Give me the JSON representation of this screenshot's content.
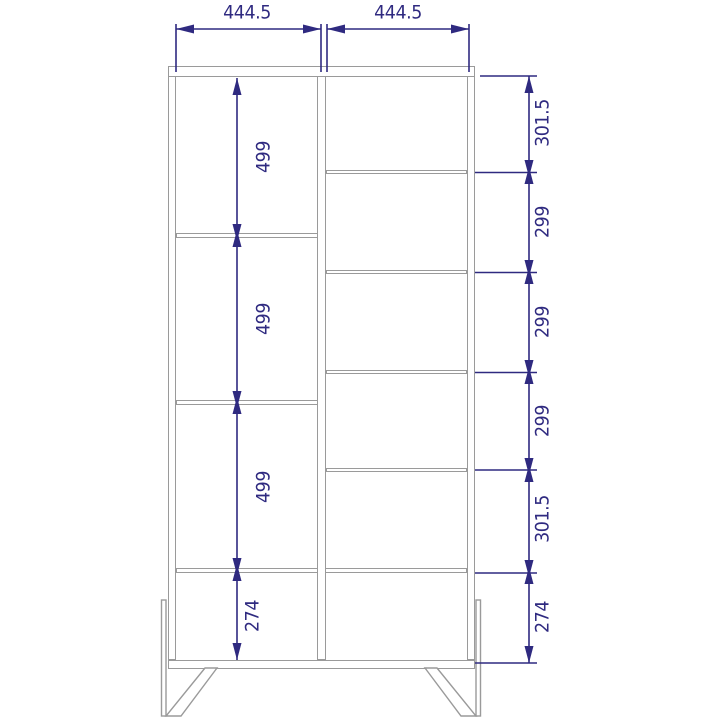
{
  "drawing": {
    "kind": "furniture-technical-drawing",
    "description": "Front elevation of a two-bay shelving cabinet on angled legs, with linear dimension annotations",
    "units": "mm",
    "colors": {
      "dimension_blue": "#2f2a80",
      "outline_gray": "#9a9a9a",
      "background": "#ffffff"
    },
    "top_dimensions": [
      "444.5",
      "444.5"
    ],
    "left_bay_heights": [
      "499",
      "499",
      "499",
      "274"
    ],
    "right_bay_heights": [
      "301.5",
      "299",
      "299",
      "299",
      "301.5",
      "274"
    ]
  }
}
